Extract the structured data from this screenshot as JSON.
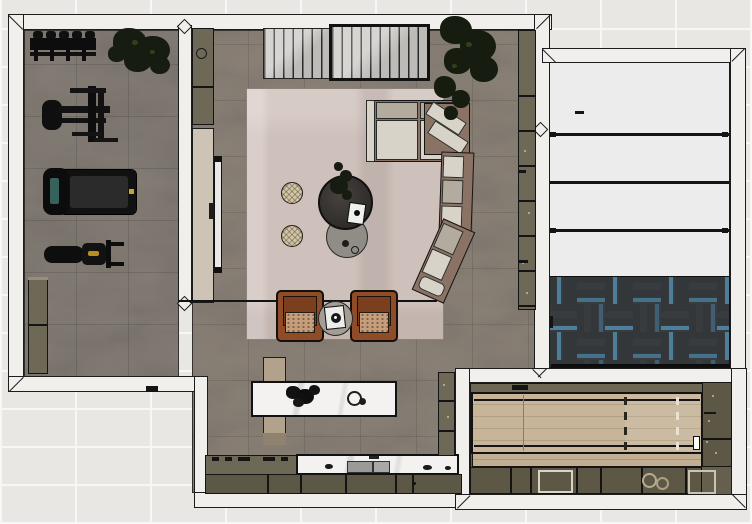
{
  "scene": {
    "type": "3d-floor-plan-top-down-render",
    "rooms": [
      {
        "id": "gym",
        "items": [
          "dumbbell-rack",
          "potted-plant",
          "weight-machine",
          "treadmill",
          "weight-bench",
          "storage-cabinet"
        ]
      },
      {
        "id": "living-room",
        "items": [
          "slatted-cabinet",
          "framed-slatted-cabinet",
          "corner-plant",
          "sectional-sofa",
          "area-rug",
          "round-coffee-table",
          "nesting-side-table",
          "table-plant",
          "pouf",
          "pouf",
          "leather-armchair",
          "leather-armchair",
          "round-side-table",
          "wall-console",
          "wall-cabinet-strip"
        ]
      },
      {
        "id": "kitchen-bar",
        "items": [
          "marble-island",
          "wood-bench",
          "flower-centerpiece",
          "bowls",
          "cooktop-counter",
          "sink-counter",
          "base-cabinets",
          "tall-cabinet"
        ]
      },
      {
        "id": "garage-room",
        "items": [
          "white-panel-door",
          "herringbone-mat"
        ]
      },
      {
        "id": "games-room",
        "items": [
          "wood-lane-floor",
          "lane-dashed-markings",
          "top-ledge",
          "bottom-cabinets",
          "side-cabinets",
          "decor-frames"
        ]
      }
    ]
  },
  "palette": {
    "bgTile": "#e9e7e3",
    "grout": "#f8f7f5",
    "wall": "#f0efec",
    "wallLine": "#1c1c1c",
    "floorGym": "#837c74",
    "floorLiving": "#8a8177",
    "olive": "#6e6856",
    "oliveDark": "#5d5746",
    "beige": "#cdc4b5",
    "rug": "#cec0ba",
    "sofaBrown": "#8a7365",
    "cushionLight": "#d7d3c9",
    "cushionDark": "#b3ab9e",
    "cognac": "#8f4c26",
    "cognacSeat": "#c59f7c",
    "tableDark": "#37332f",
    "tableGrey": "#908c86",
    "pouf": "#d2c5a5",
    "marble": "#f3f2f0",
    "bench": "#b2a28c",
    "woodLane": "#c7b499",
    "woodSeam": "#b2a083",
    "hbBase": "#393d40",
    "hbBlue": "#4e7f9a",
    "panel": "#ececec",
    "plant": "#161c10",
    "tv": "#e9e9e7",
    "ink": "#141414"
  }
}
